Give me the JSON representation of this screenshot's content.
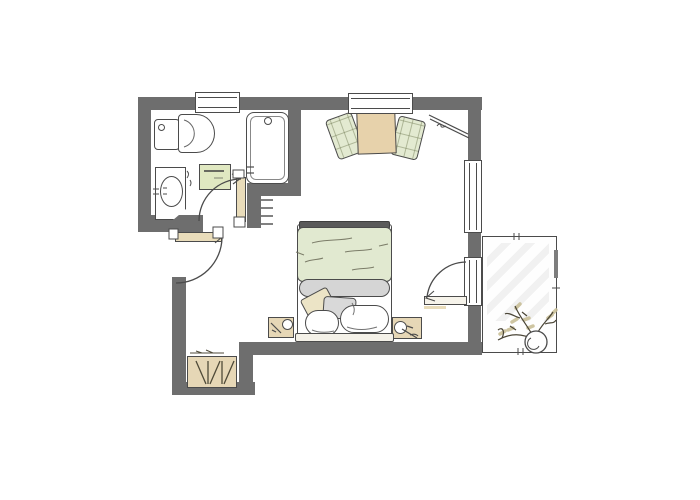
{
  "app": {
    "title": "Studio apartment floor plan",
    "view": "top-down architectural drawing"
  },
  "colors": {
    "wall": "#6e6e6e",
    "outline": "#4b4b4b",
    "wood": "#e6d7b6",
    "door_wood": "#e9dcba",
    "table_wood": "#e7d2ab",
    "textile_green": "#e3ead1",
    "duvet_green": "#e1e9d0",
    "cabinet_green": "#e0e8c1",
    "blanket_gray": "#d5d5d5",
    "pillow_beige": "#ece4c6",
    "pillow_gray": "#d9d9d9",
    "footboard_gray": "#5a5a5a",
    "paper_white": "#ffffff",
    "plant_stroke": "#4a4536",
    "leaf": "#c9bf98"
  },
  "rooms": [
    {
      "name": "bathroom",
      "fixtures": [
        "toilet",
        "washbasin-vanity",
        "bathtub",
        "storage-cabinet",
        "towel-rail",
        "bathroom-door"
      ]
    },
    {
      "name": "bedroom",
      "furniture": [
        "double-bed",
        "nightstand-left",
        "nightstand-right",
        "dining-table",
        "chair-left",
        "chair-right",
        "corner-rod"
      ]
    },
    {
      "name": "entry",
      "furniture": [
        "wardrobe",
        "entrance-door"
      ]
    },
    {
      "name": "balcony",
      "furniture": [
        "potted-plant"
      ],
      "access": "balcony-door"
    }
  ],
  "openings": {
    "windows": [
      "top-left-window",
      "top-right-window",
      "right-wall-window"
    ],
    "doors": [
      "entrance-door",
      "bathroom-door",
      "balcony-door"
    ]
  },
  "bed": {
    "parts": [
      "footboard-bar",
      "green-duvet",
      "folded-blanket",
      "tilted-pillow",
      "gray-pillow",
      "white-pillow-left",
      "white-pillow-right",
      "headboard-bar"
    ]
  }
}
